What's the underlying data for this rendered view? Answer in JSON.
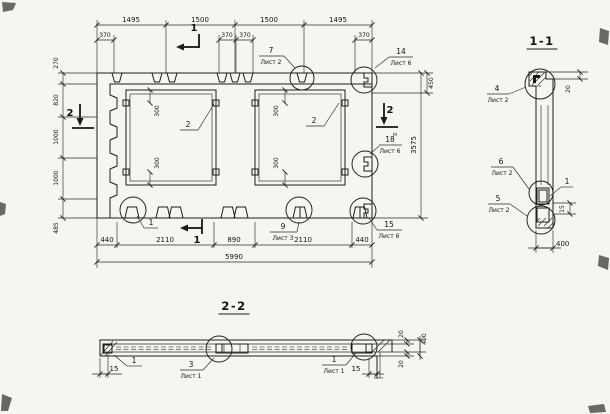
{
  "plan": {
    "dims_top": [
      "1495",
      "1500",
      "1500",
      "1495"
    ],
    "dims_row2": [
      "370",
      "370",
      "370",
      "370"
    ],
    "dim_450": "450",
    "dims_left": [
      "270",
      "820",
      "1000",
      "1000",
      "485"
    ],
    "dim_height_total": "3575",
    "dims_bottom": [
      "440",
      "2110",
      "890",
      "2110",
      "440"
    ],
    "dim_width_total": "5990",
    "opening_dims": [
      "300",
      "300",
      "300",
      "300"
    ],
    "opening_callouts": [
      "2",
      "2"
    ],
    "section_markers": {
      "top": "1",
      "bottom": "1",
      "left": "2",
      "right": "2",
      "right_letter": "н"
    },
    "callouts": {
      "top": {
        "num": "7",
        "sheet": "Лист 2"
      },
      "top_right": {
        "num": "14",
        "sheet": "Лист 6"
      },
      "right": {
        "num": "18",
        "sheet": "Лист 6"
      },
      "bottom_left": {
        "num": "1"
      },
      "bottom_mid": {
        "num": "9",
        "sheet": "Лист 3"
      },
      "bottom_right": {
        "num": "15",
        "sheet": "Лист 6"
      }
    }
  },
  "section_1_1": {
    "title": "1-1",
    "callouts": {
      "top": {
        "num": "4",
        "sheet": "Лист 2"
      },
      "mid": {
        "num": "6",
        "sheet": "Лист 2"
      },
      "bottom": {
        "num": "5",
        "sheet": "Лист 2"
      },
      "item": "1"
    },
    "dims": {
      "top": "20",
      "mid": "15",
      "bottom": "400"
    }
  },
  "section_2_2": {
    "title": "2-2",
    "callouts": {
      "left": "1",
      "mid": {
        "num": "3",
        "sheet": "Лист 1"
      },
      "right": {
        "num": "1",
        "sheet": "Лист 1"
      }
    },
    "dims": {
      "left": "15",
      "tail": "15",
      "top_layer": "20",
      "bottom_layer": "20",
      "thickness": "400"
    }
  }
}
